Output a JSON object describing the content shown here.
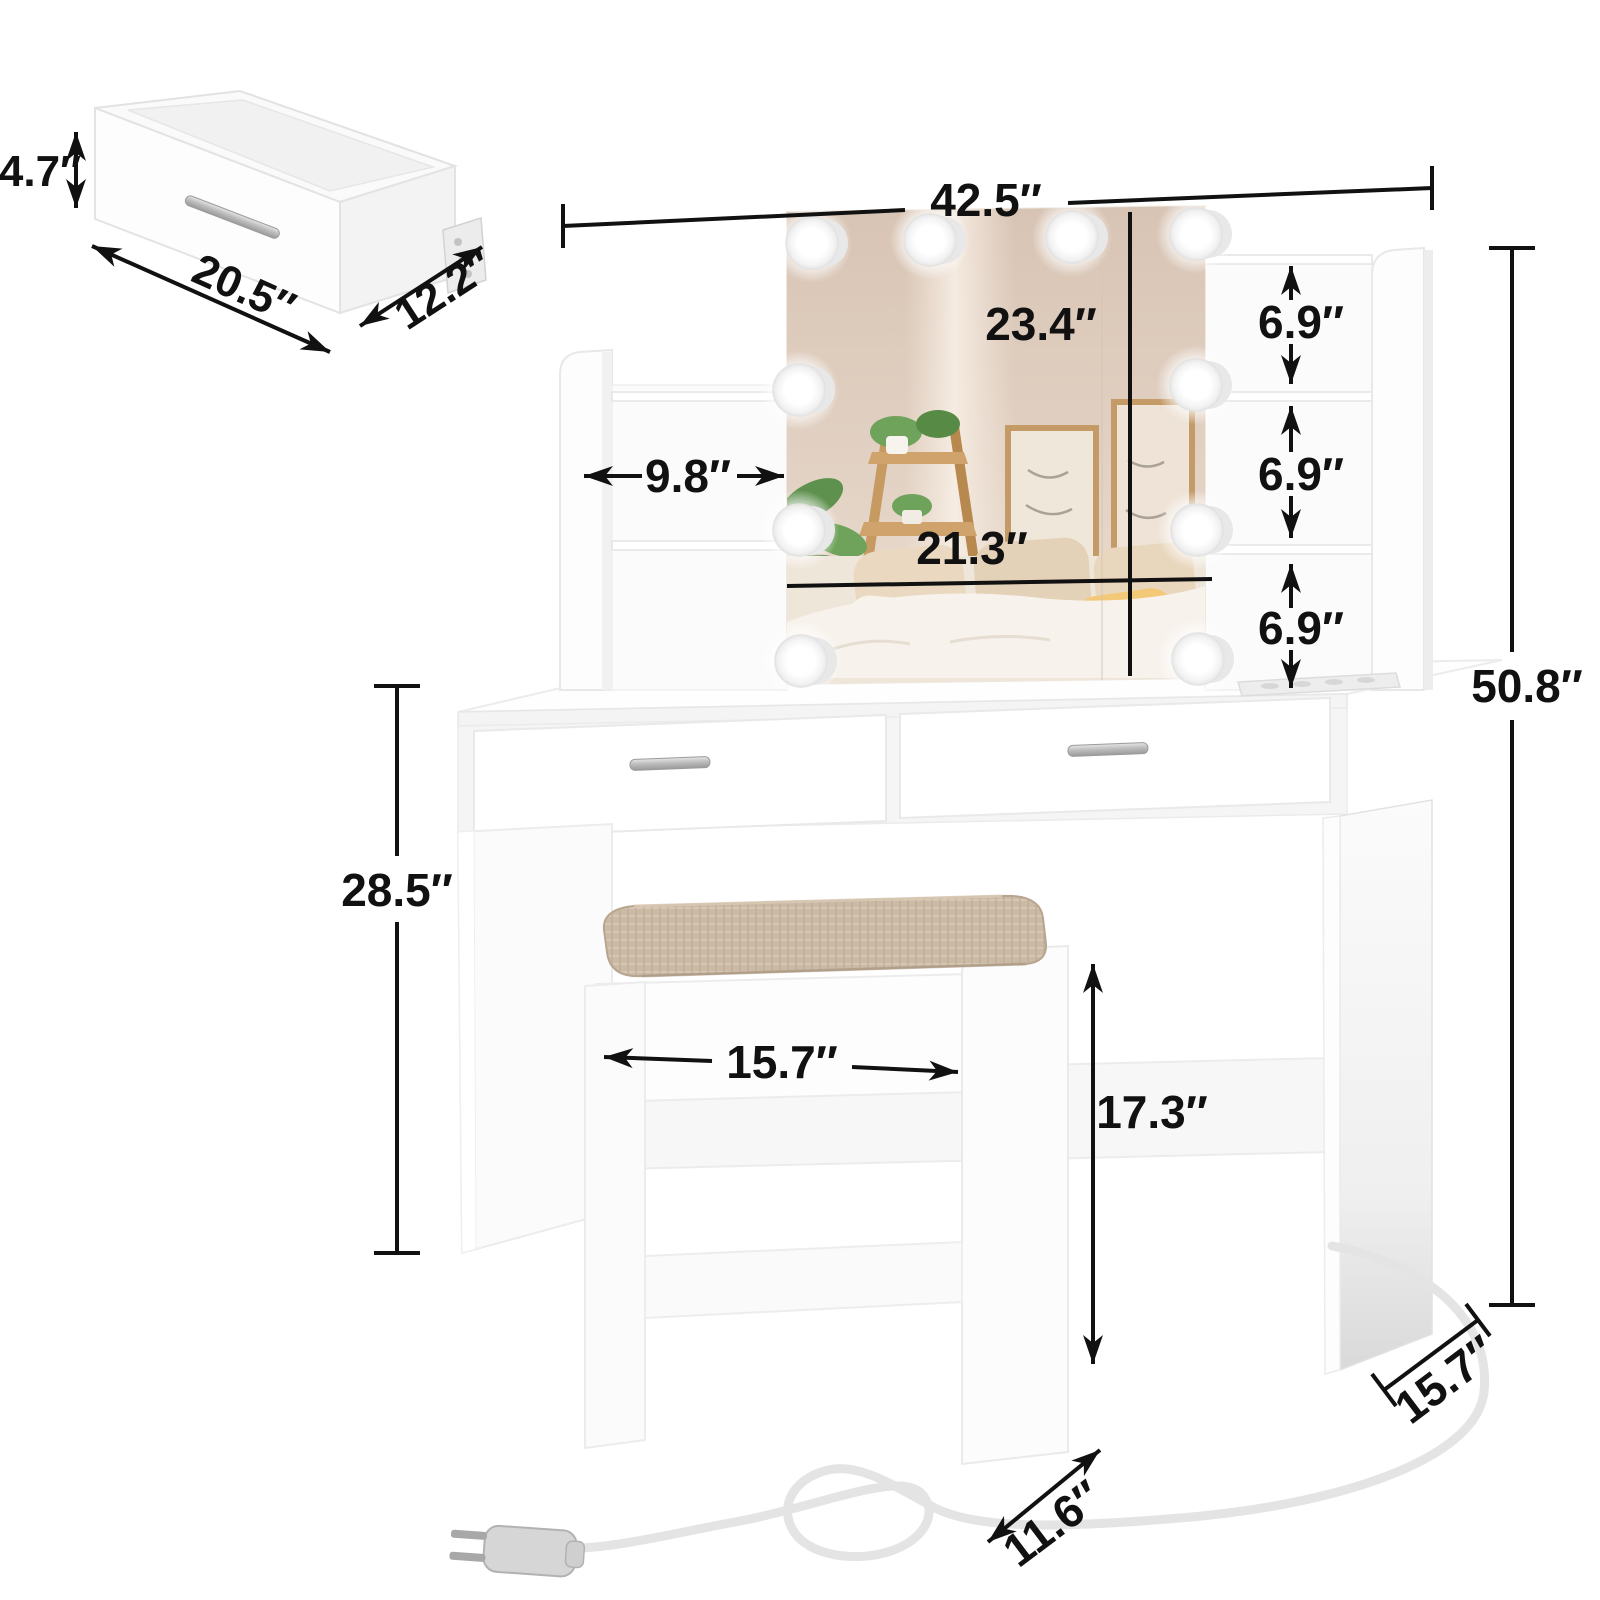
{
  "diagram": {
    "type": "product-dimension-diagram",
    "product": "vanity desk set with lighted mirror, shelves and stool",
    "accent_colors": {
      "line_color": "#111111",
      "furniture_white": "#fdfdfd",
      "cushion_linen": "#cbbaa5",
      "mirror_wall": "#dbc8b9",
      "wood_tone": "#c79a62"
    },
    "icons": {
      "light_bulb": "glowing-circle",
      "power_plug": "two-prong-plug",
      "power_cord": "looped-cable",
      "drawer_handle": "silver-bar"
    },
    "dims": {
      "drawer_height": "4.7″",
      "drawer_width": "20.5″",
      "drawer_depth": "12.2″",
      "overall_width": "42.5″",
      "mirror_height": "23.4″",
      "mirror_width": "21.3″",
      "left_shelf_width": "9.8″",
      "cubby_top": "6.9″",
      "cubby_middle": "6.9″",
      "cubby_bottom": "6.9″",
      "overall_height": "50.8″",
      "desk_height": "28.5″",
      "desk_depth": "15.7″",
      "stool_width": "15.7″",
      "stool_height": "17.3″",
      "stool_depth": "11.6″"
    }
  }
}
